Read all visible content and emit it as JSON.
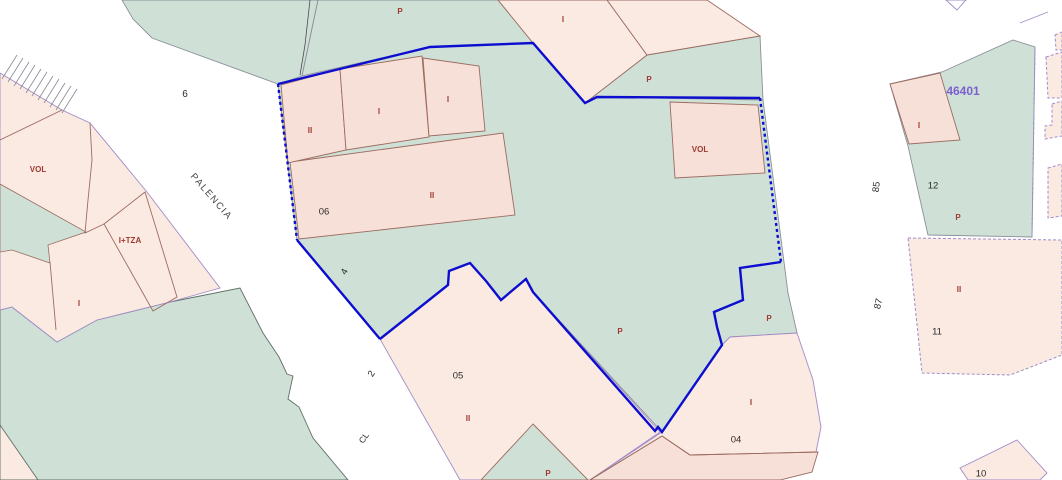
{
  "map": {
    "description": "Cadastral parcel map view",
    "selected_zone_code": "46401",
    "street_name": "PALENCIA",
    "colors": {
      "parcel_green": "#cfe1d7",
      "parcel_pink": "#fbeae2",
      "building_pink": "#f7e0d7",
      "street_white": "#ffffff",
      "parcel_boundary_purple": "#a08cc8",
      "building_line_brown": "#9c6b60",
      "selection_blue": "#0d0dd0",
      "label_red": "#a03a31",
      "label_black": "#2b2b2b",
      "zone_label_purple": "#7c5fd0"
    },
    "labels": [
      {
        "text": "P",
        "x": 400,
        "y": 12,
        "type": "red",
        "size": 8
      },
      {
        "text": "I",
        "x": 563,
        "y": 20,
        "type": "red",
        "size": 8
      },
      {
        "text": "P",
        "x": 649,
        "y": 80,
        "type": "red",
        "size": 8
      },
      {
        "text": "6",
        "x": 185,
        "y": 95,
        "type": "black",
        "size": 10
      },
      {
        "text": "II",
        "x": 310,
        "y": 131,
        "type": "red",
        "size": 8
      },
      {
        "text": "I",
        "x": 379,
        "y": 112,
        "type": "red",
        "size": 8
      },
      {
        "text": "I",
        "x": 448,
        "y": 100,
        "type": "red",
        "size": 8
      },
      {
        "text": "VOL",
        "x": 38,
        "y": 170,
        "type": "red",
        "size": 8
      },
      {
        "text": "VOL",
        "x": 700,
        "y": 150,
        "type": "red",
        "size": 8
      },
      {
        "text": "PALENCIA",
        "x": 211,
        "y": 197,
        "rot": 49,
        "type": "street",
        "size": 9.5
      },
      {
        "text": "06",
        "x": 324,
        "y": 212,
        "type": "black",
        "size": 9.5
      },
      {
        "text": "II",
        "x": 432,
        "y": 196,
        "type": "red",
        "size": 8
      },
      {
        "text": "I+TZA",
        "x": 130,
        "y": 241,
        "type": "red",
        "size": 8
      },
      {
        "text": "4",
        "x": 345,
        "y": 272,
        "rot": -60,
        "type": "black",
        "size": 9.5
      },
      {
        "text": "I",
        "x": 79,
        "y": 304,
        "type": "red",
        "size": 8
      },
      {
        "text": "P",
        "x": 620,
        "y": 332,
        "type": "red",
        "size": 8
      },
      {
        "text": "2",
        "x": 372,
        "y": 374,
        "rot": -58,
        "type": "black",
        "size": 9.5
      },
      {
        "text": "05",
        "x": 458,
        "y": 376,
        "type": "black",
        "size": 9.5
      },
      {
        "text": "II",
        "x": 468,
        "y": 419,
        "type": "red",
        "size": 8
      },
      {
        "text": "CL",
        "x": 364,
        "y": 438,
        "rot": -55,
        "type": "black",
        "size": 8.5
      },
      {
        "text": "P",
        "x": 548,
        "y": 474,
        "type": "red",
        "size": 8
      },
      {
        "text": "P",
        "x": 769,
        "y": 319,
        "type": "red",
        "size": 8
      },
      {
        "text": "I",
        "x": 751,
        "y": 403,
        "type": "red",
        "size": 8
      },
      {
        "text": "04",
        "x": 736,
        "y": 440,
        "type": "black",
        "size": 9.5
      },
      {
        "text": "85",
        "x": 877,
        "y": 187,
        "rot": -84,
        "type": "black",
        "size": 9.5
      },
      {
        "text": "87",
        "x": 879,
        "y": 304,
        "rot": -76,
        "type": "black",
        "size": 9.5
      },
      {
        "text": "46401",
        "x": 963,
        "y": 91,
        "type": "zone",
        "size": 12
      },
      {
        "text": "I",
        "x": 919,
        "y": 126,
        "type": "red",
        "size": 8
      },
      {
        "text": "12",
        "x": 933,
        "y": 186,
        "type": "black",
        "size": 9.5
      },
      {
        "text": "P",
        "x": 958,
        "y": 218,
        "type": "red",
        "size": 8
      },
      {
        "text": "II",
        "x": 959,
        "y": 290,
        "type": "red",
        "size": 8
      },
      {
        "text": "11",
        "x": 937,
        "y": 332,
        "type": "black",
        "size": 9.5
      },
      {
        "text": "10",
        "x": 981,
        "y": 474,
        "type": "black",
        "size": 9.5
      }
    ]
  }
}
